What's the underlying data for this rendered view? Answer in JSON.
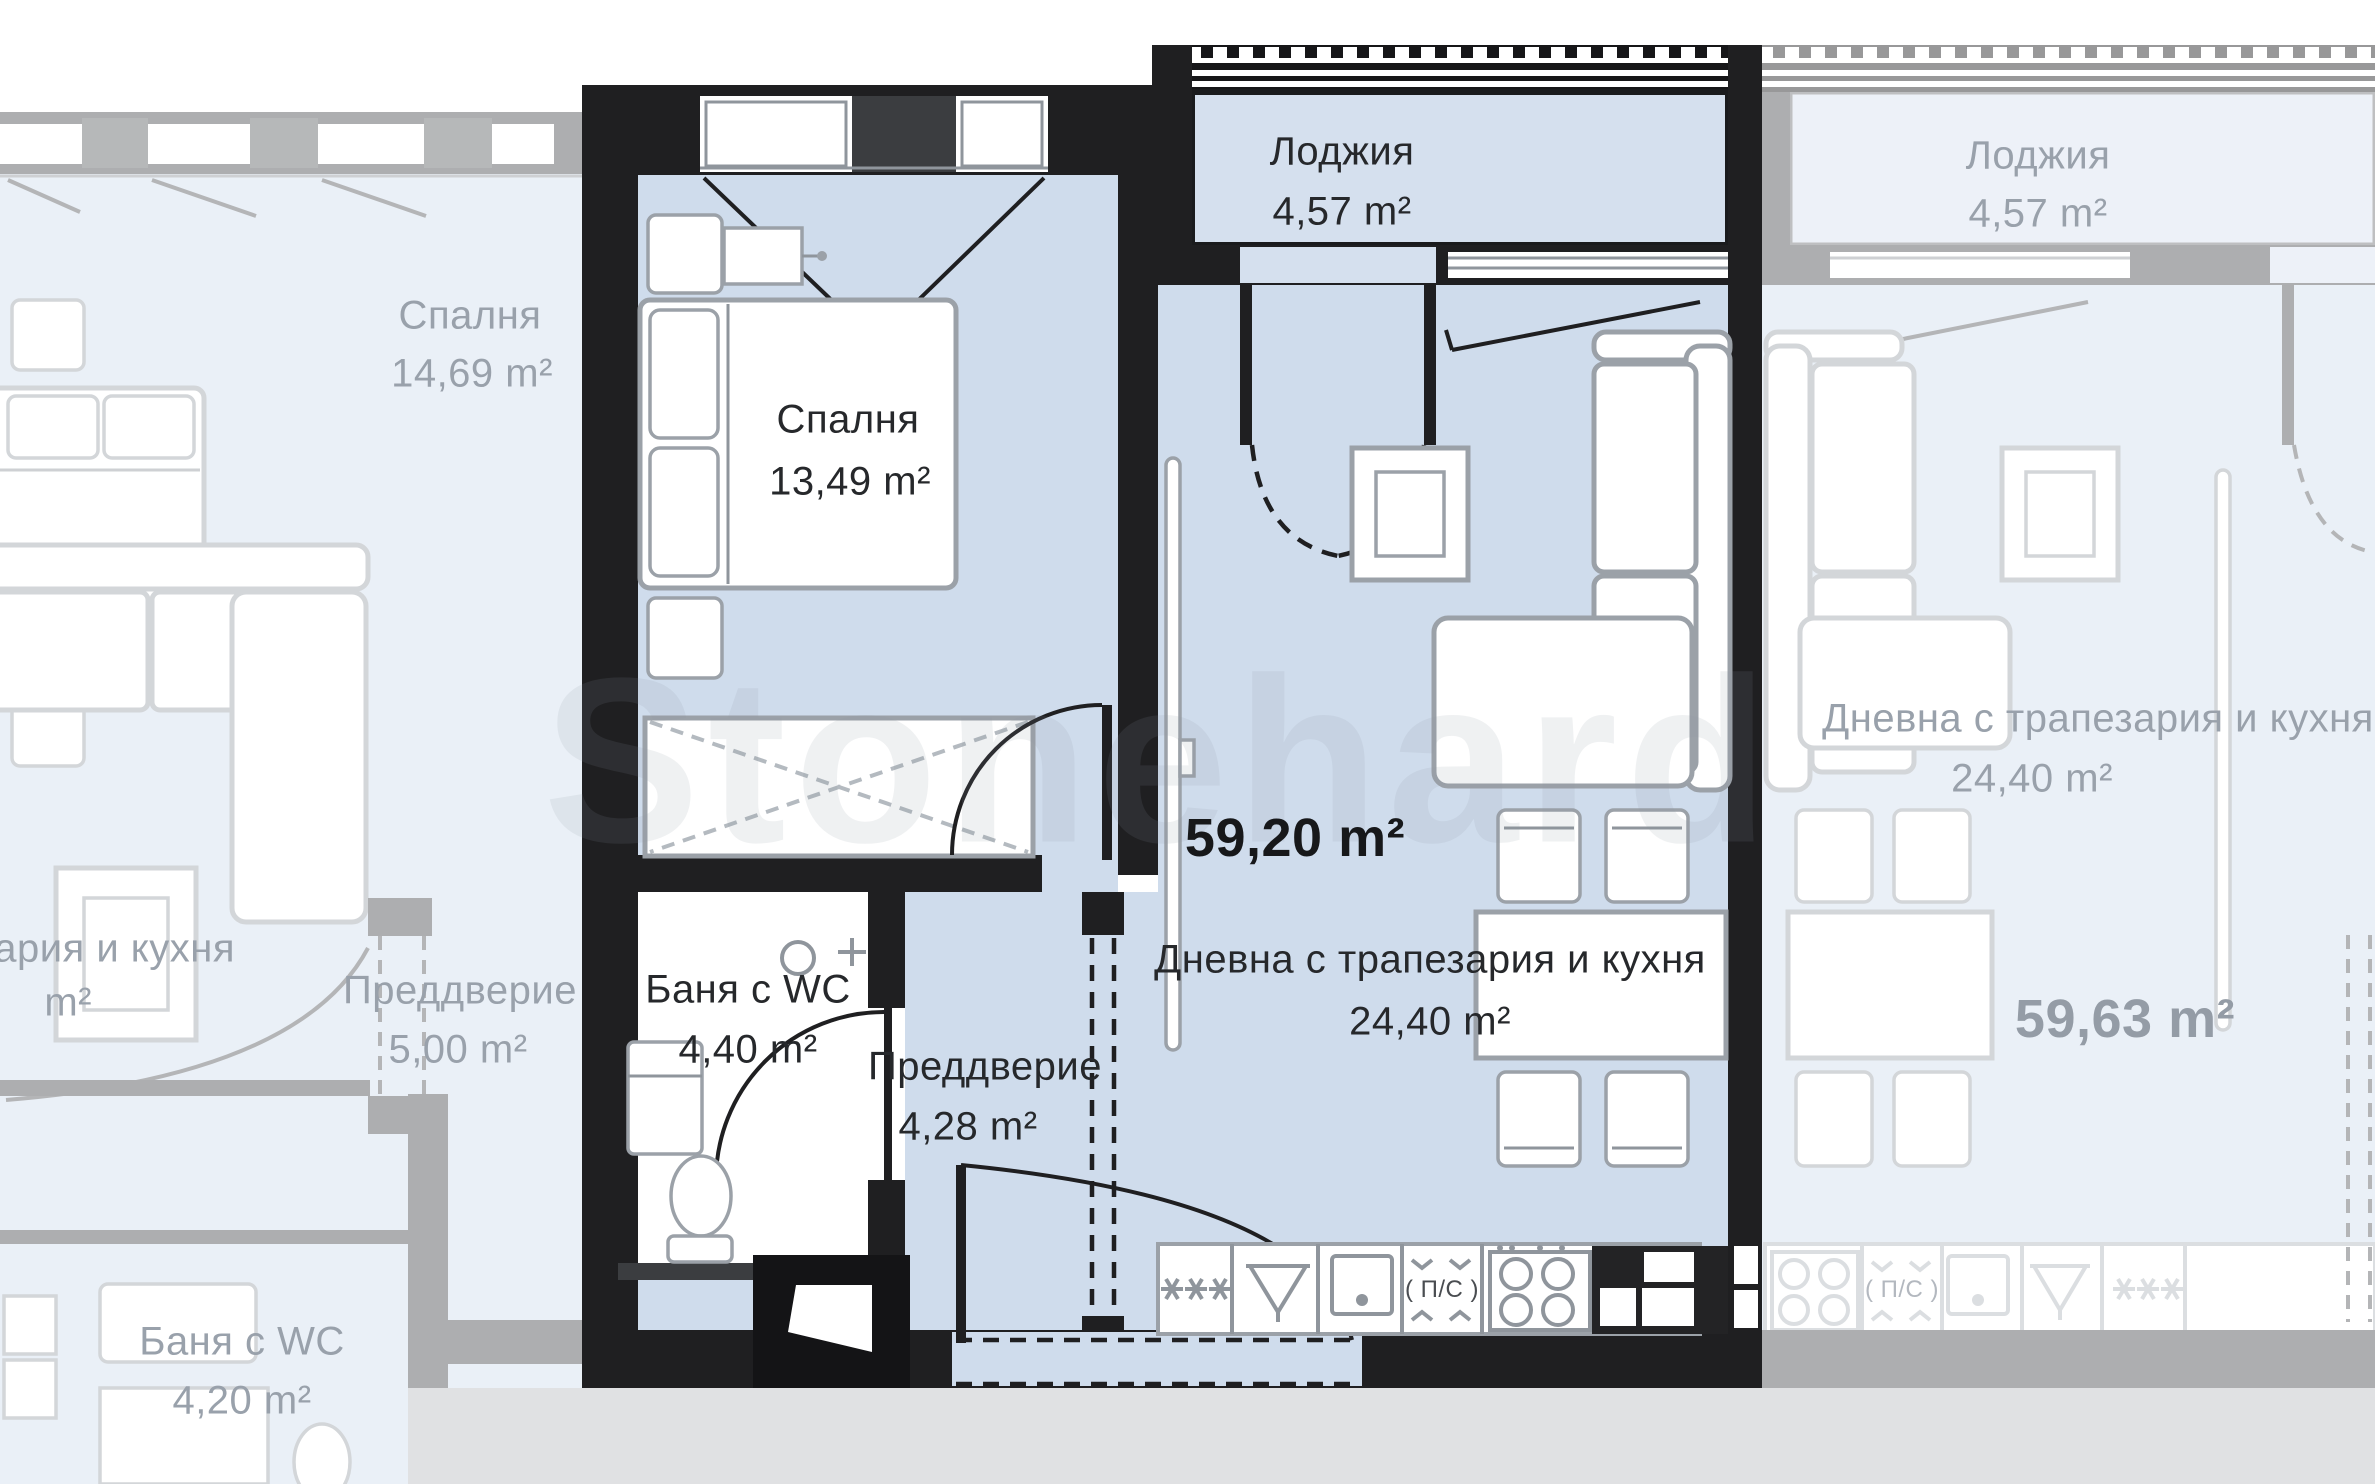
{
  "watermark": {
    "text": "Stonehard"
  },
  "apartments": {
    "left": {
      "bedroom": {
        "label": "Спалня",
        "area": "14,69 m²"
      },
      "living": {
        "label_fragment": "ария и кухня",
        "area_fragment": "m²"
      },
      "hallway": {
        "label": "Преддверие",
        "area": "5,00 m²"
      },
      "bathroom": {
        "label": "Баня с WC",
        "area": "4,20 m²"
      }
    },
    "main": {
      "total_area": "59,20 m²",
      "loggia": {
        "label": "Лоджия",
        "area": "4,57 m²"
      },
      "bedroom": {
        "label": "Спалня",
        "area": "13,49 m²"
      },
      "bathroom": {
        "label": "Баня с WC",
        "area": "4,40 m²"
      },
      "hallway": {
        "label": "Преддверие",
        "area": "4,28 m²"
      },
      "living": {
        "label": "Дневна с трапезария и кухня",
        "area": "24,40 m²"
      },
      "kitchen": {
        "dishwasher_label": "( П/С )"
      }
    },
    "right": {
      "total_area": "59,63 m²",
      "loggia": {
        "label": "Лоджия",
        "area": "4,57 m²"
      },
      "living": {
        "label": "Дневна с трапезария и кухня",
        "area": "24,40 m²"
      },
      "kitchen": {
        "dishwasher_label": "( П/С )"
      }
    }
  },
  "colors": {
    "room_fill": "#cfdcec",
    "loggia_fill": "#d5e0ee",
    "wall": "#1f1f21",
    "text": "#26282b",
    "faded_text": "#99a1ab",
    "floor_strip": "#e0e1e3"
  }
}
